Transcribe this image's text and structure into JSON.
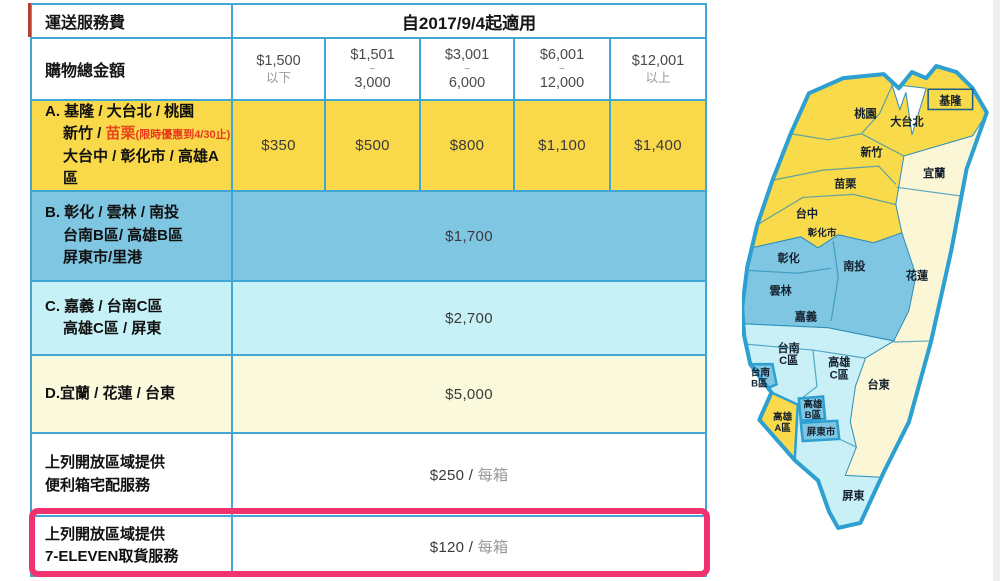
{
  "header": {
    "title": "運送服務費",
    "effective": "自2017/9/4起適用"
  },
  "tiers_row": {
    "label": "購物總金額",
    "tiers": [
      {
        "l1": "$1,500",
        "l2": "以下"
      },
      {
        "l1": "$1,501",
        "tilde": "~",
        "l3": "3,000"
      },
      {
        "l1": "$3,001",
        "tilde": "~",
        "l3": "6,000"
      },
      {
        "l1": "$6,001",
        "tilde": "~",
        "l3": "12,000"
      },
      {
        "l1": "$12,001",
        "l2": "以上"
      }
    ]
  },
  "zones": {
    "a": {
      "line1": "A. 基隆 / 大台北 / 桃園",
      "line2_black": "新竹 / ",
      "line2_red": "苗栗",
      "line2_note": "(限時優惠到4/30止)",
      "line3": "大台中 / 彰化市 / 高雄A區",
      "prices": [
        "$350",
        "$500",
        "$800",
        "$1,100",
        "$1,400"
      ]
    },
    "b": {
      "line1": "B. 彰化 / 雲林 / 南投",
      "line2": "台南B區/ 高雄B區",
      "line3": "屏東市/里港",
      "price": "$1,700"
    },
    "c": {
      "line1": "C. 嘉義 / 台南C區",
      "line2": "高雄C區 / 屏東",
      "price": "$2,700"
    },
    "d": {
      "line1": "D.宜蘭 / 花蓮 / 台東",
      "price": "$5,000"
    },
    "box": {
      "line1": "上列開放區域提供",
      "line2": "便利箱宅配服務",
      "price": "$250 / ",
      "unit": "每箱"
    },
    "seven": {
      "line1": "上列開放區域提供",
      "line2": "7-ELEVEN取貨服務",
      "price": "$120 / ",
      "unit": "每箱"
    }
  },
  "colors": {
    "zone_a": "#f9d84a",
    "zone_b": "#7fc6e2",
    "zone_c": "#c6f1f7",
    "zone_d": "#fcfadc",
    "table_border": "#3fa6d6",
    "highlight": "#f0336e",
    "promo_red": "#e8471d"
  },
  "map": {
    "labels": [
      {
        "t": "基隆"
      },
      {
        "t": "大台北"
      },
      {
        "t": "桃園"
      },
      {
        "t": "新竹"
      },
      {
        "t": "宜蘭"
      },
      {
        "t": "苗栗"
      },
      {
        "t": "台中"
      },
      {
        "t": "彰化市"
      },
      {
        "t": "彰化"
      },
      {
        "t": "南投"
      },
      {
        "t": "花蓮"
      },
      {
        "t": "雲林"
      },
      {
        "t": "嘉義"
      },
      {
        "t": "台南",
        "t2": "C區"
      },
      {
        "t": "高雄",
        "t2": "C區"
      },
      {
        "t": "台南",
        "t2": "B區"
      },
      {
        "t": "台東"
      },
      {
        "t": "高雄",
        "t2": "B區"
      },
      {
        "t": "高雄",
        "t2": "A區"
      },
      {
        "t": "屏東市"
      },
      {
        "t": "屏東"
      }
    ]
  }
}
